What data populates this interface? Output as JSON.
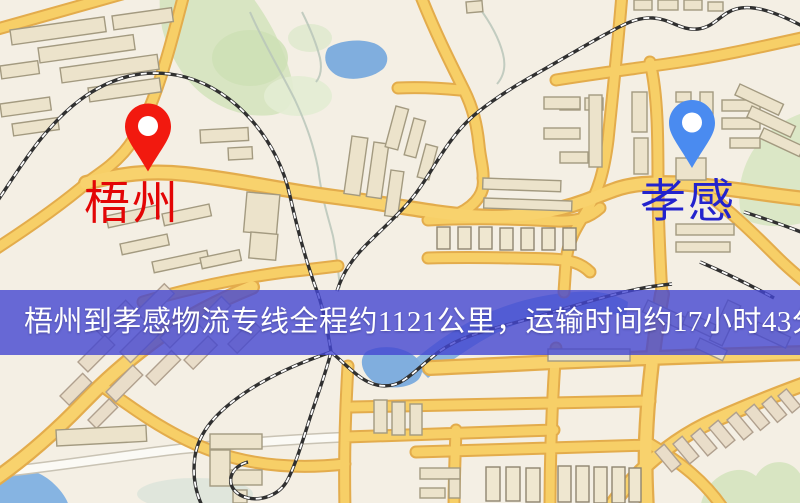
{
  "banner": {
    "text": "梧州到孝感物流专线全程约1121公里，运输时间约17小时43分钟."
  },
  "route": {
    "distance_km": "1121",
    "duration_hours": "17",
    "duration_minutes": "43"
  },
  "markers": {
    "origin": {
      "label": "梧州",
      "pin_color": "#f2190f",
      "label_color": "#e30505"
    },
    "destination": {
      "label": "孝感",
      "pin_color": "#4a8bf0",
      "label_color": "#2323cd"
    }
  },
  "colors": {
    "map_background": "#f4efe4",
    "road_fill": "#f7cf67",
    "road_casing": "#e3ac4c",
    "minor_road": "#fbfaf5",
    "water": "#80aede",
    "park": "#d8e5c2",
    "building_fill": "#ece3cb",
    "building_stroke": "#a39a80",
    "railway": "#303030",
    "banner_background": "rgba(67,70,209,0.8)",
    "banner_text": "#ffffff"
  }
}
